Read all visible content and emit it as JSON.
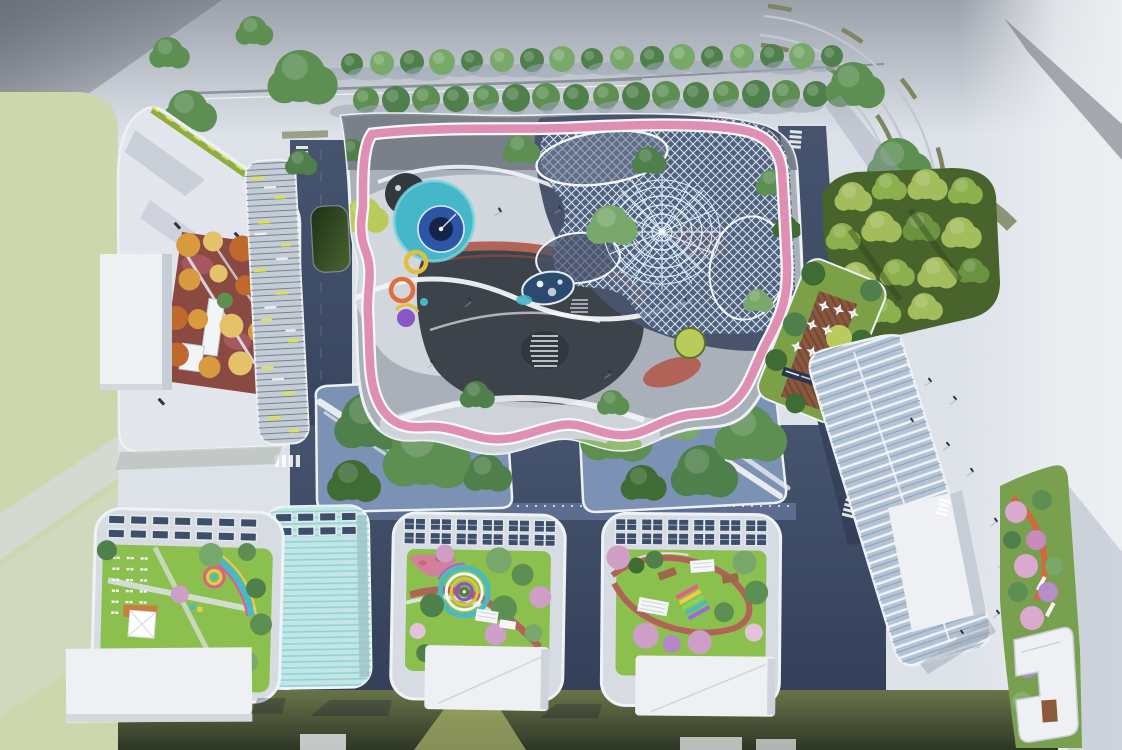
{
  "palette": {
    "bg_top": "#9ba1ab",
    "bg_main": "#dde2e9",
    "bg_right": "#eceef2",
    "corner_dark": "#6b7078",
    "grass": "#ccd7ae",
    "grass_band": "#d4d9d3",
    "olive_top": "#6a744a",
    "olive_bottom": "#2e3626",
    "olive_wedge": "#a3ad68",
    "road_navy_1": "#46546f",
    "road_navy_2": "#333f58",
    "road_light_strip": "#5f7195",
    "curb_white": "#eef1f4",
    "road_line": "#8b929b",
    "olive_lane": "#7e8560",
    "arc_gray": "#c2c8cf",
    "plaza_base": "#a9b0ba",
    "plaza_light": "#d2d7de",
    "plaza_dark": "#6d747e",
    "plaza_charcoal": "#3c434b",
    "plaza_deepblue": "#49536b",
    "track_pink": "#e08fb4",
    "path_white": "#f2f4f7",
    "red_path": "#b26358",
    "lawn_patch": "#8fb968",
    "pool_teal": "#45b7c8",
    "pool_blue": "#2d55a5",
    "pool_navy": "#15254a",
    "pond_blue": "#2b4a70",
    "ring_yellow": "#e3bf3d",
    "ring_orange": "#df6f3d",
    "ring_purple": "#8a55c8",
    "mesh_base": "#54617c",
    "mesh_line": "#cfe4f6",
    "tree_green_1": "#5d8f53",
    "tree_green_2": "#4f7f4a",
    "tree_green_3": "#79a86b",
    "tree_dark": "#3f6b35",
    "tree_yellowgreen": "#b9cb5a",
    "tree_autumn_1": "#d89a3e",
    "tree_autumn_2": "#c0692f",
    "tree_autumn_3": "#e4c26a",
    "tree_pink": "#cf9ec6",
    "tree_pink_2": "#d9a9ce",
    "tree_purple": "#9a8fc9",
    "lawn": "#8cc04e",
    "flower_pink": "#d4809a",
    "flower_red": "#a65762",
    "courtyard_red": "#8a4a42",
    "building_roof": "#e2e6ec",
    "building_white": "#eef0f3",
    "building_shade": "#c7cdd6",
    "louver_base": "#c4ccd6",
    "louver_line": "#79828f",
    "louver_accent": "#dde24e",
    "teal_glass": "#c2e6e6",
    "teal_stripe": "#8fd0d2",
    "solar_cell": "#3d4f6b",
    "solar_frame": "#e6eaee",
    "glass_base": "#b3c2d3",
    "glass_stripe": "#f0f4f8",
    "glass_stripe_dark": "#8ba0b6",
    "forest_base": "#49632c",
    "forest_tree_1": "#a3bd5c",
    "forest_tree_2": "#8db04e",
    "terrace_green": "#7ca048",
    "deck_brown": "#8a573f",
    "deck_stripe": "#6e4434",
    "sign_navy": "#2b3750",
    "garden_green": "#79a04e",
    "orange_path": "#d2693e",
    "court_blue": "#7b92b4",
    "pond_dark_1": "#1c2f16",
    "pond_dark_2": "#4a6530",
    "green_edge": "#8fae3f",
    "shadow_soft": "#9aa5b5",
    "people_dark": "#2e343b",
    "rainbow_1": "#e85a8a",
    "rainbow_2": "#f2c94c",
    "rainbow_3": "#7ed957",
    "rainbow_4": "#49b9c6",
    "rainbow_5": "#9b6ad6"
  }
}
